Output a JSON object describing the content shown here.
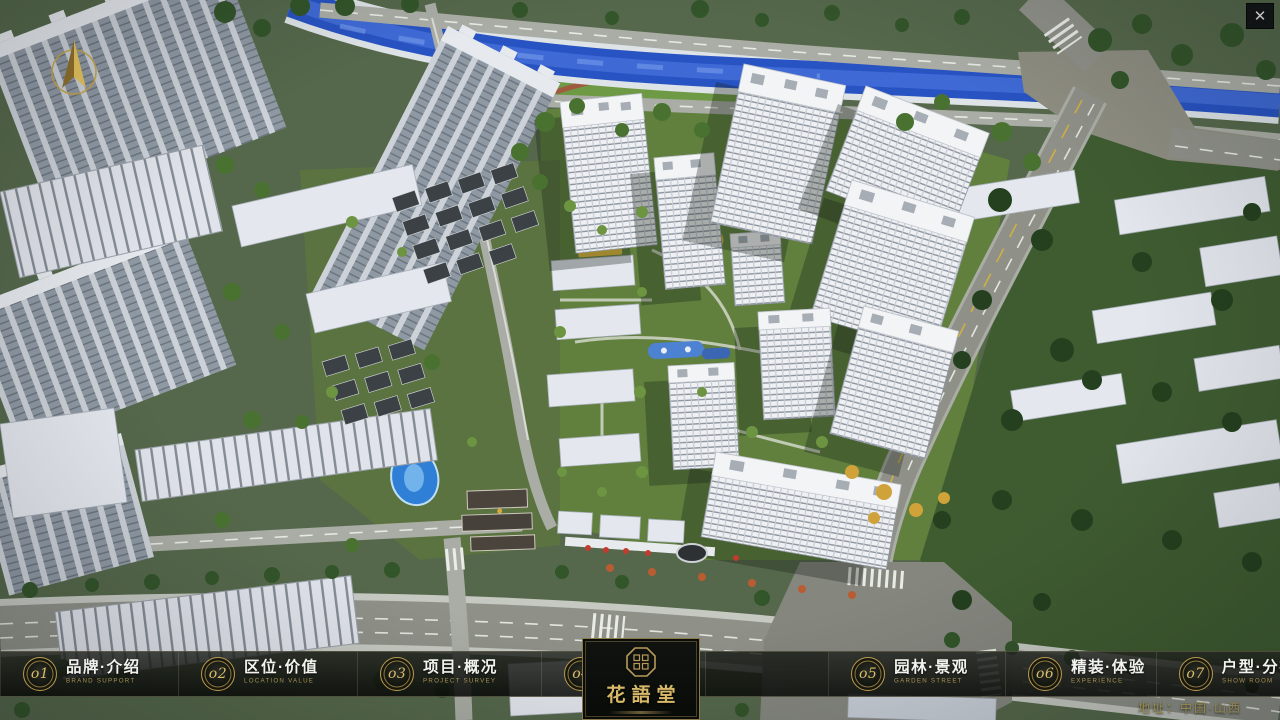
{
  "icons": {
    "close": "✕"
  },
  "nav": {
    "items": [
      {
        "num": "o1",
        "label": "品牌·介绍",
        "sub": "BRAND SUPPORT"
      },
      {
        "num": "o2",
        "label": "区位·价值",
        "sub": "LOCATION VALUE"
      },
      {
        "num": "o3",
        "label": "项目·概况",
        "sub": "PROJECT SURVEY"
      },
      {
        "num": "o4",
        "label": "建筑·鉴赏",
        "sub": "APPRECIATION"
      },
      {
        "num": "o5",
        "label": "园林·景观",
        "sub": "GARDEN STREET"
      },
      {
        "num": "o6",
        "label": "精装·体验",
        "sub": "EXPERIENCE"
      },
      {
        "num": "o7",
        "label": "户型·分布",
        "sub": "SHOW ROOM"
      },
      {
        "num": "o8",
        "label": "一房·一景",
        "sub": "COMMUNITY"
      }
    ]
  },
  "logo": {
    "title": "花語堂"
  },
  "footer": {
    "address": "地址：中国·山西"
  }
}
